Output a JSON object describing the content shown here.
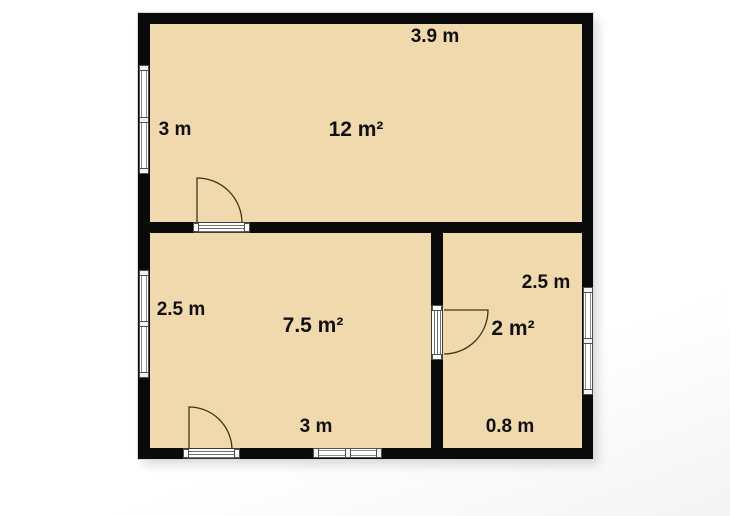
{
  "title": "floor-plan",
  "rooms": [
    {
      "name": "top-room",
      "area": "12 m²",
      "width": "3.9 m",
      "height": "3 m"
    },
    {
      "name": "bottom-left-room",
      "area": "7.5 m²",
      "width": "3 m",
      "height": "2.5 m"
    },
    {
      "name": "bottom-right-room",
      "area": "2 m²",
      "width": "0.8 m",
      "height": "2.5 m"
    }
  ],
  "colors": {
    "floor": "#f1d9ae",
    "wall": "#0a0a0a",
    "door": "#3f3417",
    "label": "#111111",
    "window_frame": "#4f4f4f",
    "background": "#ffffff"
  }
}
